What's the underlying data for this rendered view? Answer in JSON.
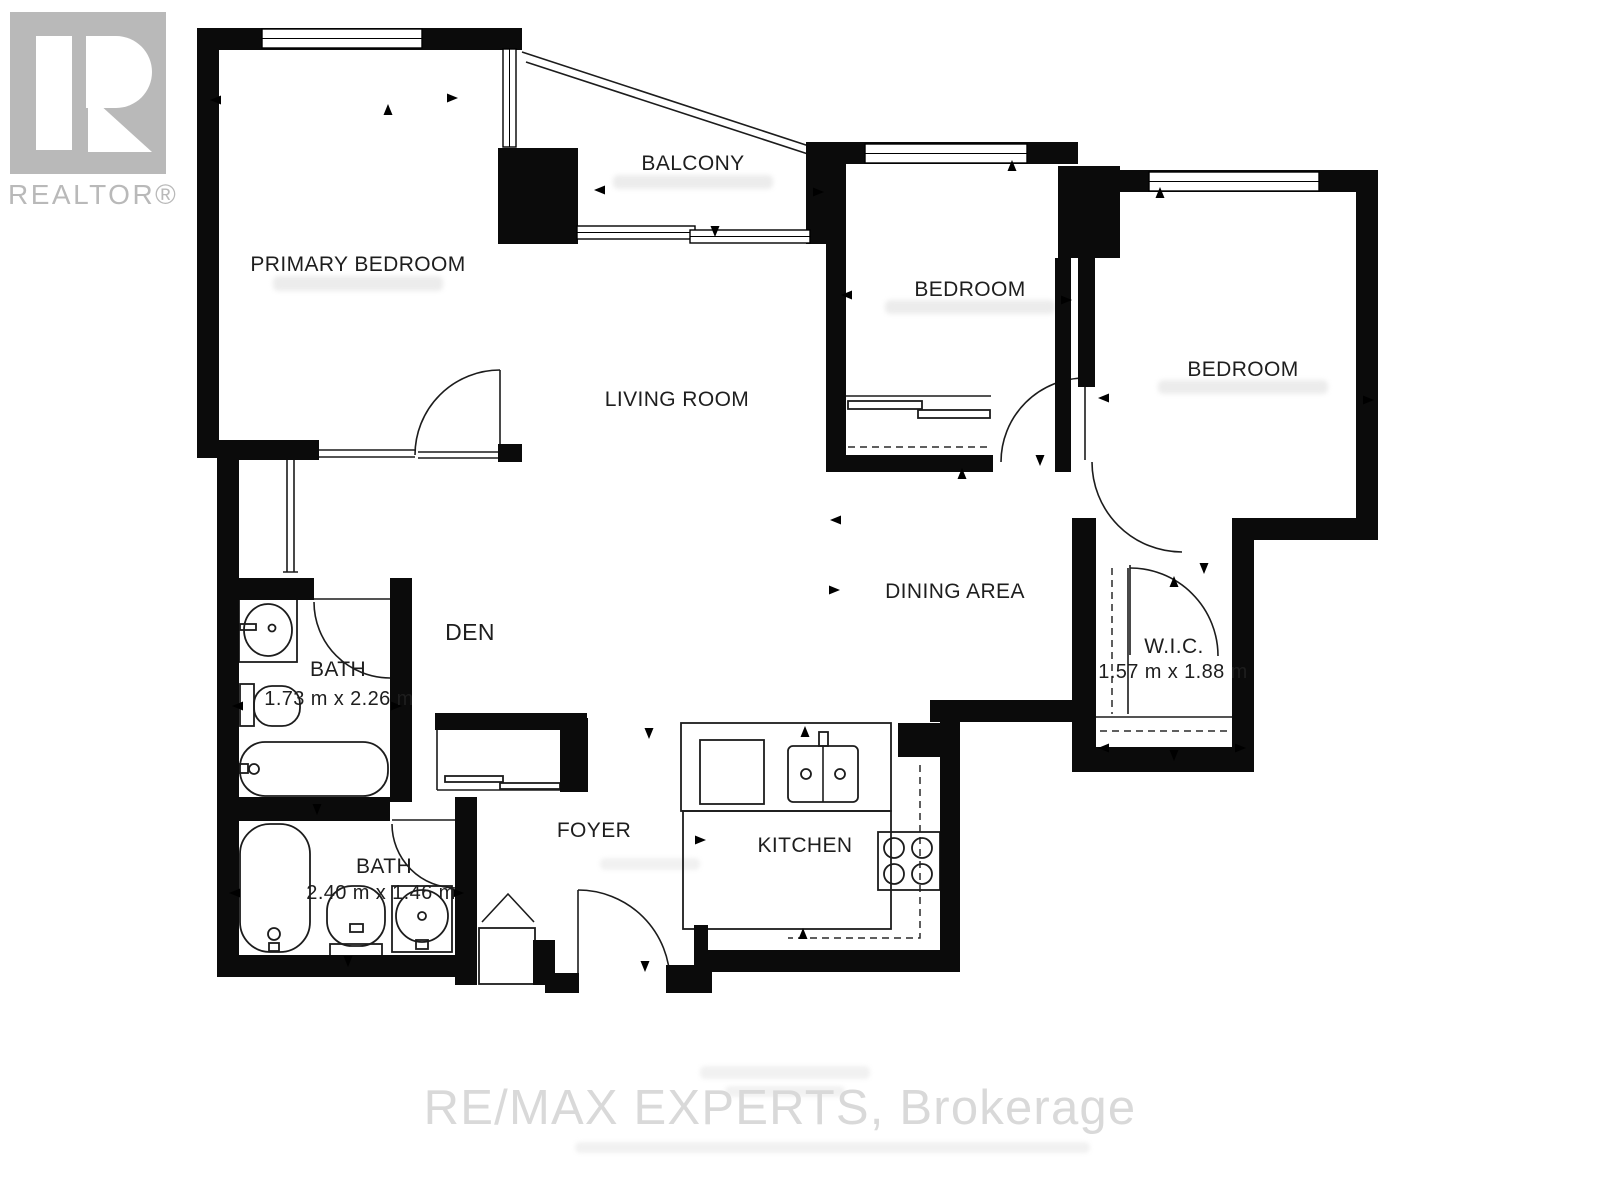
{
  "branding": {
    "logo_text": "REALTOR®",
    "logo_color": "#b9b9b9",
    "watermark_text": "RE/MAX EXPERTS, Brokerage",
    "watermark_color": "#d9d9d9"
  },
  "floor_plan": {
    "wall_color": "#0b0b0b",
    "rooms": [
      {
        "id": "primary-bedroom",
        "label": "PRIMARY BEDROOM"
      },
      {
        "id": "balcony",
        "label": "BALCONY"
      },
      {
        "id": "bedroom-1",
        "label": "BEDROOM"
      },
      {
        "id": "bedroom-2",
        "label": "BEDROOM"
      },
      {
        "id": "living-room",
        "label": "LIVING ROOM"
      },
      {
        "id": "dining-area",
        "label": "DINING AREA"
      },
      {
        "id": "den",
        "label": "DEN"
      },
      {
        "id": "wic",
        "label": "W.I.C.",
        "dimensions": "1.57 m x 1.88 m"
      },
      {
        "id": "bath-main",
        "label": "BATH",
        "dimensions": "1.73 m x 2.26 m"
      },
      {
        "id": "bath-second",
        "label": "BATH",
        "dimensions": "2.40 m x 1.46 m"
      },
      {
        "id": "foyer",
        "label": "FOYER"
      },
      {
        "id": "kitchen",
        "label": "KITCHEN"
      }
    ]
  }
}
